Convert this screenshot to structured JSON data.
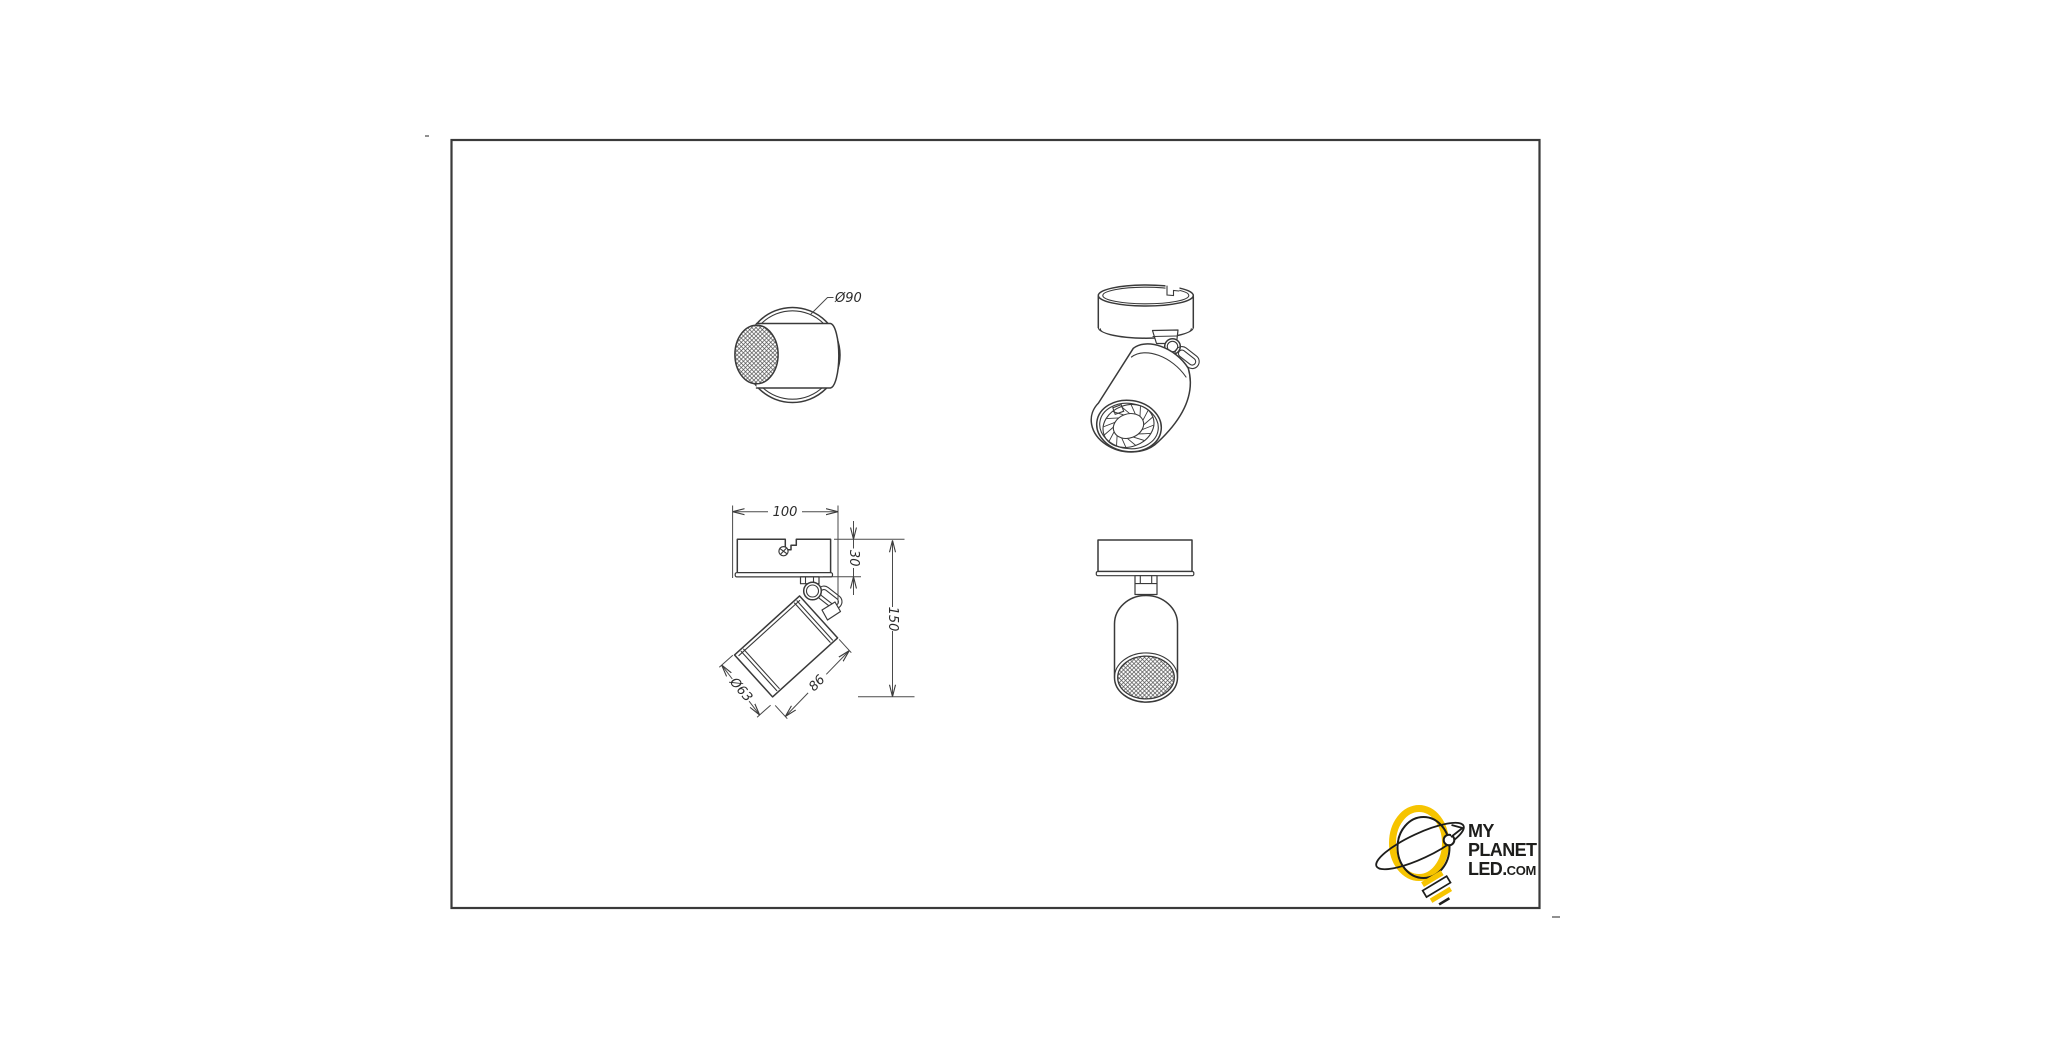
{
  "frame": {
    "border_color": "#3a3a3a"
  },
  "dimensions": {
    "canopy_diameter": "Ø90",
    "canopy_width": "100",
    "canopy_height": "30",
    "overall_height": "150",
    "head_diameter": "Ø63",
    "head_length": "86"
  },
  "logo": {
    "line1": "MY",
    "line2": "PLANET",
    "line3_main": "LED.",
    "line3_suffix": "COM",
    "accent_color": "#F6C400",
    "text_color": "#1d1d1b"
  }
}
